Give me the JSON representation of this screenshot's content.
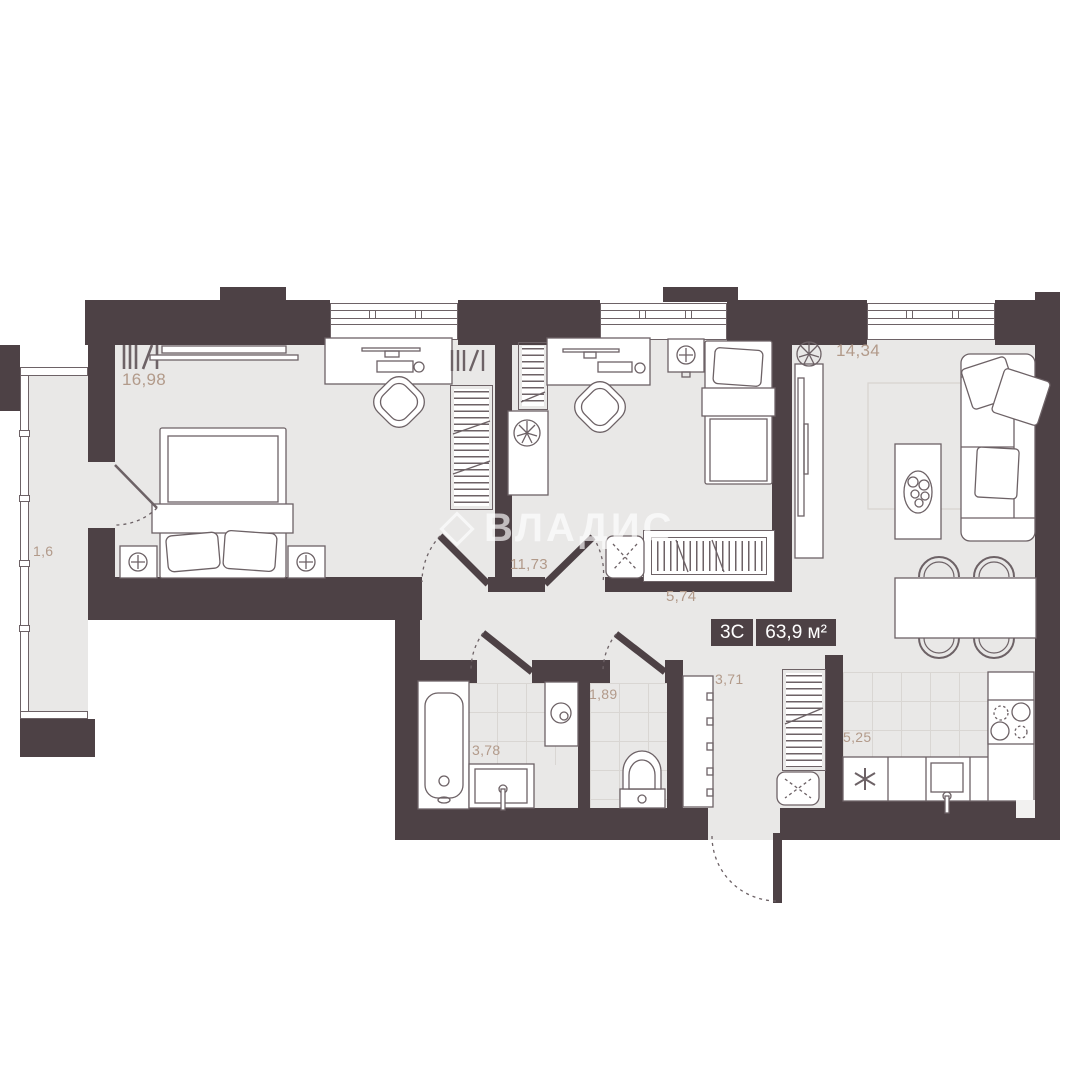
{
  "plan": {
    "badge": {
      "rooms_label": "3С",
      "area_label": "63,9 м²"
    },
    "watermark": "ВЛАДИС",
    "rooms": {
      "bedroom": {
        "name": "bedroom",
        "area": "16,98"
      },
      "balcony": {
        "name": "balcony",
        "area": "1,6"
      },
      "kidsroom": {
        "name": "second-bedroom",
        "area": "11,73"
      },
      "corridor": {
        "name": "corridor",
        "area": "5,74"
      },
      "living": {
        "name": "living-room",
        "area": "14,34"
      },
      "bathroom": {
        "name": "bathroom",
        "area": "3,78"
      },
      "wc": {
        "name": "wc",
        "area": "1,89"
      },
      "hallway": {
        "name": "hallway",
        "area": "3,71"
      },
      "kitchen": {
        "name": "kitchen",
        "area": "5,25"
      }
    },
    "colors": {
      "wall": "#4d4145",
      "floor": "#e9e8e7",
      "label": "#b29a8a",
      "line": "#6d6266",
      "tile": "#d9d6d3",
      "badge_text": "#ffffff"
    }
  }
}
